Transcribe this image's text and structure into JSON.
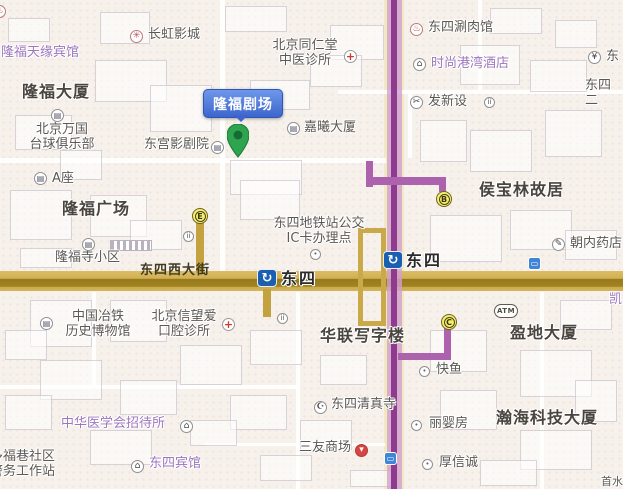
{
  "map": {
    "area_name": "东四",
    "colors": {
      "background": "#f7f1ec",
      "main_road": "#cfa94e",
      "subway_line": "#8e3a8e",
      "bus_route": "#c9aa4c",
      "callout_blue": "#3c66cc",
      "pin_green": "#2ea44f",
      "exit_marker_yellow": "#f4ed6d",
      "station_icon_blue": "#1b5fb0"
    }
  },
  "callout": {
    "label": "隆福剧场"
  },
  "stations": [
    {
      "id": "dongsi-station-line5",
      "label": "东四",
      "icon_x": 383,
      "icon_y": 251,
      "label_x": 406,
      "label_y": 252
    },
    {
      "id": "dongsi-station-road",
      "label": "东四",
      "icon_x": 257,
      "icon_y": 269,
      "label_x": 281,
      "label_y": 270
    }
  ],
  "exits": [
    {
      "letter": "E",
      "x": 192,
      "y": 208
    },
    {
      "letter": "B",
      "x": 436,
      "y": 191
    },
    {
      "letter": "C",
      "x": 441,
      "y": 314
    }
  ],
  "labels": [
    {
      "id": "longfu-tianyuan-hotel",
      "text": "隆福天缘宾馆",
      "x": 1,
      "y": 46,
      "style": "purple"
    },
    {
      "id": "changhong-cinema",
      "text": "长虹影城",
      "x": 148,
      "y": 28,
      "style": "gray"
    },
    {
      "id": "tongrentang-clinic",
      "text": "北京同仁堂\n中医诊所",
      "x": 263,
      "y": 39,
      "style": "gray",
      "align": "center",
      "w": 84
    },
    {
      "id": "dongsi-shuanrou-restaurant",
      "text": "东四涮肉馆",
      "x": 428,
      "y": 21,
      "style": "gray"
    },
    {
      "id": "shishang-gangwan-hotel",
      "text": "时尚港湾酒店",
      "x": 431,
      "y": 57,
      "style": "purple"
    },
    {
      "id": "bank-east-partial",
      "text": "东",
      "x": 606,
      "y": 50,
      "style": "gray"
    },
    {
      "id": "dongsi-ertiao-street",
      "text": "东四二",
      "x": 585,
      "y": 79,
      "style": "gray"
    },
    {
      "id": "longfu-building",
      "text": "隆福大厦",
      "x": 22,
      "y": 83,
      "style": "bold"
    },
    {
      "id": "faxinshe",
      "text": "发新设",
      "x": 428,
      "y": 95,
      "style": "gray"
    },
    {
      "id": "jiaxi-building",
      "text": "嘉曦大厦",
      "x": 304,
      "y": 121,
      "style": "gray"
    },
    {
      "id": "beijing-wanguo-billiards",
      "text": "北京万国\n台球俱乐部",
      "x": 25,
      "y": 123,
      "style": "gray",
      "align": "center",
      "w": 74
    },
    {
      "id": "donggong-theater",
      "text": "东宫影剧院",
      "x": 144,
      "y": 138,
      "style": "gray"
    },
    {
      "id": "block-a",
      "text": "A座",
      "x": 52,
      "y": 172,
      "style": "gray"
    },
    {
      "id": "longfu-plaza",
      "text": "隆福广场",
      "x": 62,
      "y": 200,
      "style": "bold"
    },
    {
      "id": "houbaolin-residence",
      "text": "侯宝林故居",
      "x": 479,
      "y": 181,
      "style": "bold"
    },
    {
      "id": "dongsi-metro-ic-point",
      "text": "东四地铁站公交\nIC卡办理点",
      "x": 263,
      "y": 217,
      "style": "gray",
      "align": "center",
      "w": 112
    },
    {
      "id": "longfusi-community",
      "text": "隆福寺小区",
      "x": 55,
      "y": 251,
      "style": "gray"
    },
    {
      "id": "chaonei-pharmacy",
      "text": "朝内药店",
      "x": 570,
      "y": 237,
      "style": "gray"
    },
    {
      "id": "dongsi-west-street",
      "text": "东四西大街",
      "x": 140,
      "y": 264,
      "style": "road-label"
    },
    {
      "id": "china-metallurgy-museum",
      "text": "中国冶铁\n历史博物馆",
      "x": 58,
      "y": 310,
      "style": "gray",
      "align": "center",
      "w": 80
    },
    {
      "id": "xinwangai-dental",
      "text": "北京信望爱\n口腔诊所",
      "x": 142,
      "y": 310,
      "style": "gray",
      "align": "center",
      "w": 84
    },
    {
      "id": "kai-partial",
      "text": "凯",
      "x": 609,
      "y": 293,
      "style": "purple"
    },
    {
      "id": "yingdi-building",
      "text": "盈地大厦",
      "x": 510,
      "y": 324,
      "style": "bold"
    },
    {
      "id": "hualian-office-building",
      "text": "华联写字楼",
      "x": 320,
      "y": 327,
      "style": "bold"
    },
    {
      "id": "kuaiyu",
      "text": "快鱼",
      "x": 436,
      "y": 363,
      "style": "gray"
    },
    {
      "id": "dongsi-mosque-label",
      "text": "东四清真寺",
      "x": 331,
      "y": 398,
      "style": "gray"
    },
    {
      "id": "hanhai-tech-building",
      "text": "瀚海科技大厦",
      "x": 496,
      "y": 409,
      "style": "bold"
    },
    {
      "id": "liyingfang",
      "text": "丽婴房",
      "x": 429,
      "y": 417,
      "style": "gray"
    },
    {
      "id": "zhonghua-medical-hostel",
      "text": "中华医学会招待所",
      "x": 61,
      "y": 417,
      "style": "purple"
    },
    {
      "id": "sanyou-mall-label",
      "text": "三友商场",
      "x": 299,
      "y": 441,
      "style": "gray"
    },
    {
      "id": "houxincheng",
      "text": "厚信诚",
      "x": 439,
      "y": 456,
      "style": "gray"
    },
    {
      "id": "duofuxiang-police-station",
      "text": "多福巷社区\n警务工作站",
      "x": -10,
      "y": 450,
      "style": "gray"
    },
    {
      "id": "dongsi-hotel",
      "text": "东四宾馆",
      "x": 149,
      "y": 457,
      "style": "purple"
    },
    {
      "id": "shoushui-partial",
      "text": "首水",
      "x": 601,
      "y": 476,
      "style": "gray",
      "size": 11
    }
  ],
  "poi_icons": [
    {
      "id": "cinema-icon",
      "type": "cinema",
      "x": 130,
      "y": 30
    },
    {
      "id": "medical-cross-icon",
      "type": "medical",
      "x": 344,
      "y": 50
    },
    {
      "id": "restaurant-icon",
      "type": "restaurant",
      "x": 410,
      "y": 23
    },
    {
      "id": "hotel-bed-icon",
      "type": "hotel",
      "x": 413,
      "y": 58
    },
    {
      "id": "bank-icon",
      "type": "bank",
      "x": 588,
      "y": 51
    },
    {
      "id": "scissors-icon",
      "type": "scissors",
      "x": 410,
      "y": 96
    },
    {
      "id": "people-pair-icon-1",
      "type": "people",
      "x": 484,
      "y": 97
    },
    {
      "id": "building-icon-jiaxi",
      "type": "building",
      "x": 287,
      "y": 122
    },
    {
      "id": "billiards-club-icon",
      "type": "building",
      "x": 51,
      "y": 109
    },
    {
      "id": "theater-icon",
      "type": "building",
      "x": 211,
      "y": 141
    },
    {
      "id": "building-icon-a",
      "type": "building",
      "x": 34,
      "y": 172
    },
    {
      "id": "people-pair-icon-2",
      "type": "people",
      "x": 183,
      "y": 231
    },
    {
      "id": "community-icon",
      "type": "building",
      "x": 82,
      "y": 238
    },
    {
      "id": "dot-icon-ic-point",
      "type": "dot",
      "x": 310,
      "y": 249
    },
    {
      "id": "pencil-icon",
      "type": "pencil",
      "x": 552,
      "y": 238
    },
    {
      "id": "people-pair-icon-3",
      "type": "people",
      "x": 277,
      "y": 313
    },
    {
      "id": "museum-icon",
      "type": "building",
      "x": 40,
      "y": 317
    },
    {
      "id": "medical-cross-icon-2",
      "type": "medical",
      "x": 222,
      "y": 318
    },
    {
      "id": "dot-icon-kuaiyu",
      "type": "dot",
      "x": 419,
      "y": 366
    },
    {
      "id": "mosque-icon",
      "type": "mosque",
      "x": 314,
      "y": 401
    },
    {
      "id": "dot-icon-liyingfang",
      "type": "dot",
      "x": 411,
      "y": 420
    },
    {
      "id": "hotel-bed-icon-2",
      "type": "hotel",
      "x": 180,
      "y": 420
    },
    {
      "id": "mall-icon",
      "type": "mall",
      "x": 355,
      "y": 444
    },
    {
      "id": "dot-icon-houxincheng",
      "type": "dot",
      "x": 422,
      "y": 459
    },
    {
      "id": "hotel-bed-icon-3",
      "type": "hotel",
      "x": 131,
      "y": 460
    },
    {
      "id": "restaurant-icon-edge",
      "type": "restaurant",
      "x": -7,
      "y": 5
    }
  ],
  "bus_stops": [
    {
      "id": "bus-stop-icon-chaonei",
      "x": 528,
      "y": 257
    },
    {
      "id": "bus-stop-icon-south",
      "x": 384,
      "y": 452
    }
  ],
  "atm": {
    "label": "ATM",
    "x": 494,
    "y": 304
  }
}
